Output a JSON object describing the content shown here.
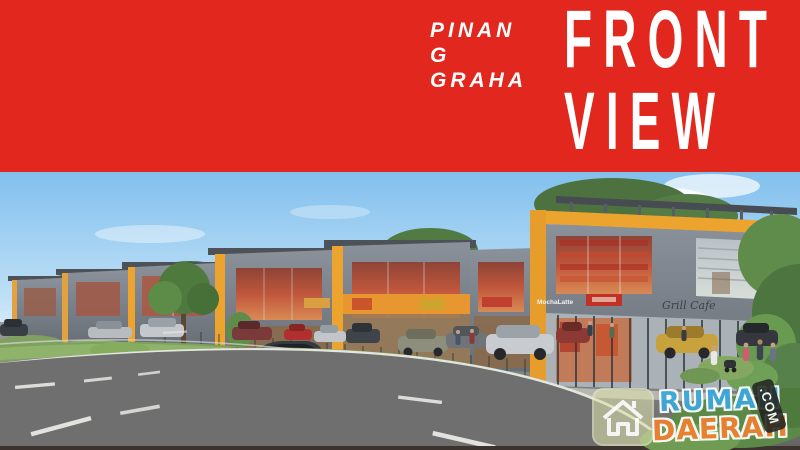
{
  "banner": {
    "background_color": "#e1271e",
    "text_color": "#ffffff",
    "brand": {
      "line1": "PINAN",
      "line2": "G",
      "line3": "GRAHA"
    },
    "title": {
      "line1": "FRONT",
      "line2": "VIEW"
    }
  },
  "scene": {
    "sky_color": "#8ac4ef",
    "accent_yellow": "#eda42e",
    "building_gray": "#7a828b",
    "road_color": "#6f6f6f",
    "signs": {
      "sign_mocha": "MochaLatte",
      "sign_grill": "Grill Cafe"
    }
  },
  "watermark": {
    "word1": "RUMAH",
    "word2": "DAERAH",
    "suffix": ".COM",
    "word1_color": "#3aa8dc",
    "word2_color": "#ef8030",
    "icon": "house-icon"
  }
}
